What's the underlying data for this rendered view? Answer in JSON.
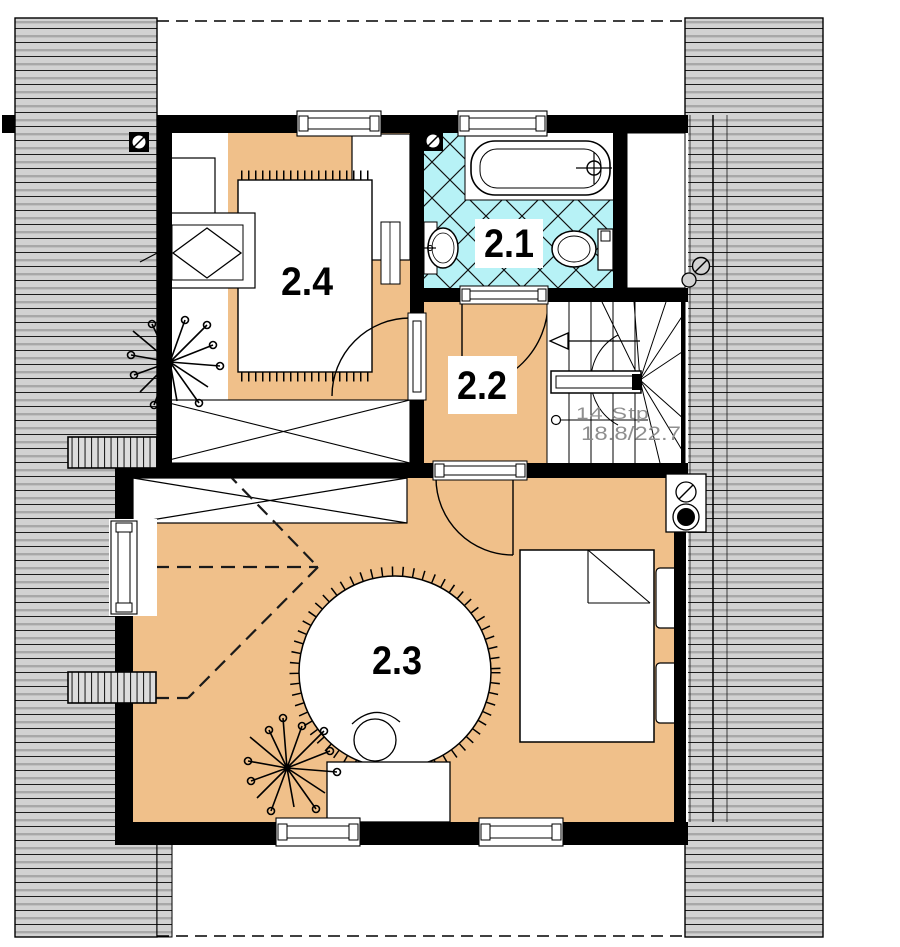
{
  "plan": {
    "room_labels": {
      "r21": "2.1",
      "r22": "2.2",
      "r23": "2.3",
      "r24": "2.4"
    },
    "stairs": {
      "steps": "14  Stp",
      "rise_run": "18.8/22.7"
    },
    "colors": {
      "floor": "#F0C08A",
      "tiles": "#B7F2F6",
      "roof_fill": "#D2D2D2",
      "roof_line": "#A8A8A8",
      "wall": "#000000",
      "stair_text": "#8F8F8F"
    }
  }
}
